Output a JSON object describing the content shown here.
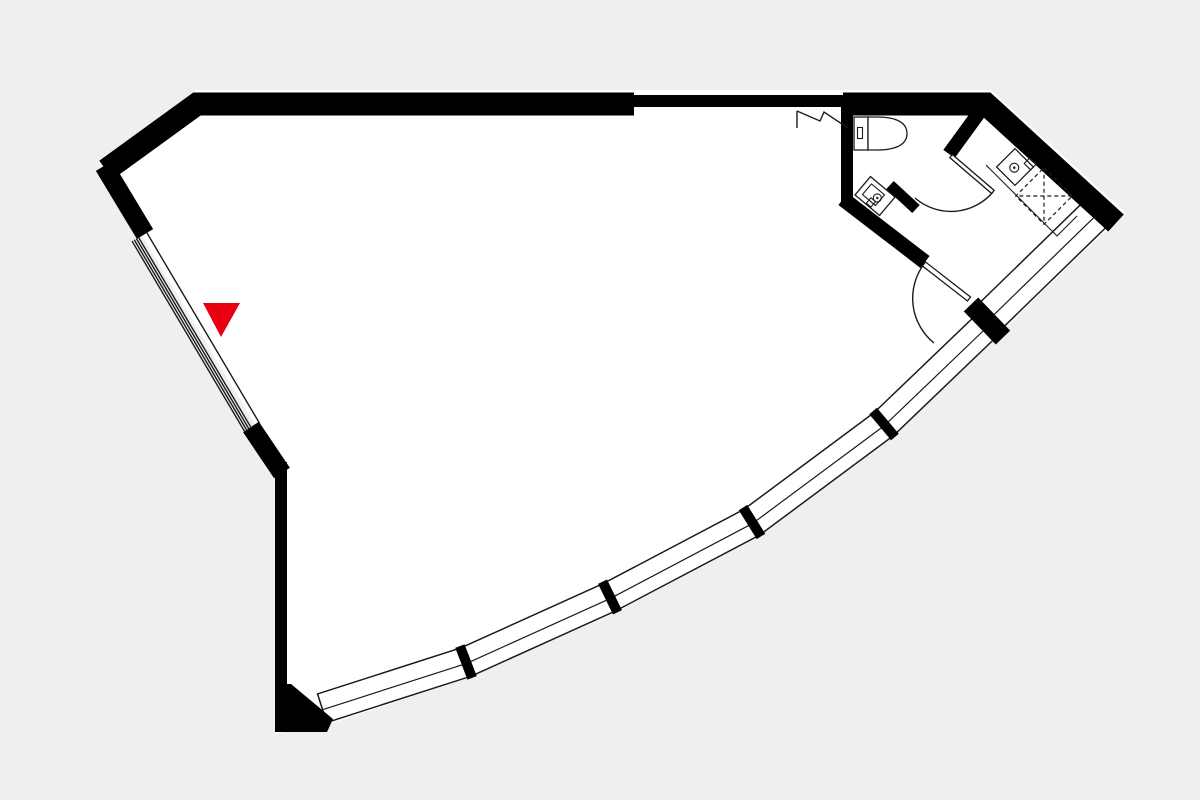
{
  "colors": {
    "background": "#efefef",
    "floor": "#ffffff",
    "wall": "#000000",
    "line": "#1b1b1b",
    "marker": "#e60012"
  },
  "plan": {
    "type": "floor-plan",
    "entrance_marker": {
      "shape": "triangle-down",
      "color": "#e60012"
    },
    "window_segments": 6,
    "window_mullions": 4,
    "window_end_column": 1,
    "hinged_doors": 3,
    "sliding_entrance_door": 1,
    "fixtures": [
      "toilet",
      "corner-hand-basin",
      "vanity-basin",
      "counter",
      "appliance-dashed-outline"
    ],
    "symbols": [
      "zigzag-wall-break"
    ]
  }
}
